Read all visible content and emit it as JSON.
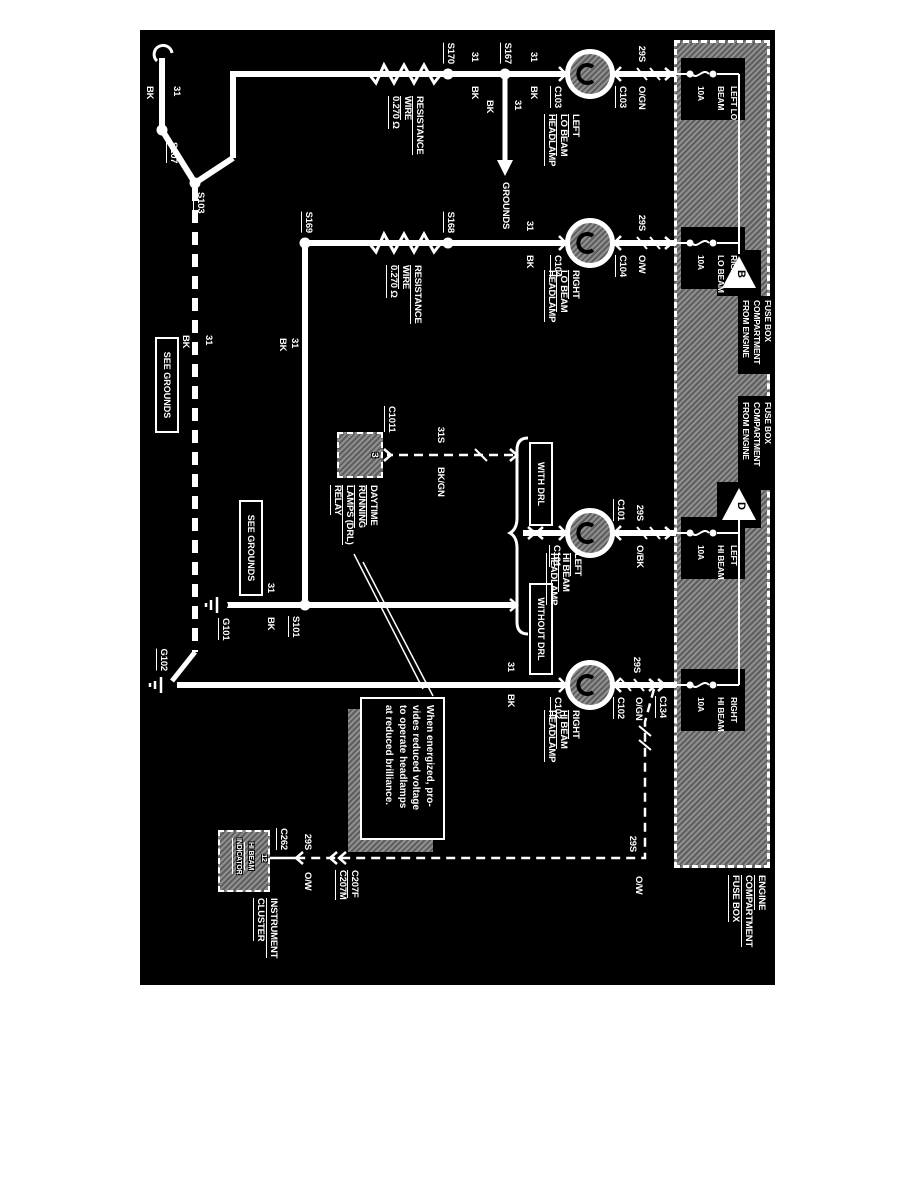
{
  "fuse_box": {
    "title_lines": [
      "ENGINE",
      "COMPARTMENT",
      "FUSE BOX"
    ],
    "from_label_lines": [
      "FROM ENGINE",
      "COMPARTMENT",
      "FUSE BOX"
    ],
    "triangles": [
      "B",
      "D"
    ],
    "fuses": [
      {
        "line1": "LEFT LO",
        "line2": "BEAM",
        "rating": "10A"
      },
      {
        "line1": "RIGHT",
        "line2": "LO BEAM",
        "rating": "10A"
      },
      {
        "line1": "LEFT",
        "line2": "HI BEAM",
        "rating": "10A"
      },
      {
        "line1": "RIGHT",
        "line2": "HI BEAM",
        "rating": "10A"
      }
    ]
  },
  "lamps": [
    {
      "name1": "LEFT",
      "name2": "LO BEAM",
      "name3": "HEADLAMP",
      "connector": "C103",
      "feed": "29S",
      "feed_color": "O/GN",
      "gnd": "31",
      "gnd_color": "BK"
    },
    {
      "name1": "RIGHT",
      "name2": "LO BEAM",
      "name3": "HEADLAMP",
      "connector": "C104",
      "feed": "29S",
      "feed_color": "O/W",
      "gnd": "31",
      "gnd_color": "BK"
    },
    {
      "name1": "LEFT",
      "name2": "HI BEAM",
      "name3": "HEADLAMP",
      "connector": "C101",
      "feed": "29S",
      "feed_color": "O/BK",
      "gnd": "31",
      "gnd_color": "BK"
    },
    {
      "name1": "RIGHT",
      "name2": "HI BEAM",
      "name3": "HEADLAMP",
      "connector": "C102",
      "feed": "29S",
      "feed_color": "O/GN",
      "gnd": "31",
      "gnd_color": "BK"
    }
  ],
  "resistor": {
    "line1": "RESISTANCE",
    "line2": "WIRE",
    "line3": "0.270 Ω"
  },
  "splices": {
    "s101": "S101",
    "s103": "S103",
    "s107": "S107",
    "s167": "S167",
    "s168": "S168",
    "s169": "S169",
    "s170": "S170"
  },
  "grounds": {
    "g101": "G101",
    "g102": "G102"
  },
  "labels": {
    "see_grounds": "SEE GROUNDS",
    "grounds": "GROUNDS",
    "with_drl": "WITH DRL",
    "without_drl": "WITHOUT DRL",
    "wire31": "31",
    "wire31_color": "BK",
    "wire31s": "31S",
    "wire31s_color": "BK/GN",
    "wire29s": "29S",
    "wire29s_ow": "O/W"
  },
  "relay": {
    "connector": "C1011",
    "pin": "3",
    "name1": "DAYTIME",
    "name2": "RUNNING",
    "name3": "LAMPS (DRL)",
    "name4": "RELAY"
  },
  "note": {
    "line1": "When energized, pro-",
    "line2": "vides reduced voltage",
    "line3": "to operate headlamps",
    "line4": "at reduced brilliance."
  },
  "cluster": {
    "name1": "INSTRUMENT",
    "name2": "CLUSTER",
    "ind1": "HI BEAM",
    "ind2": "INDICATOR",
    "pin": "12",
    "connector": "C262",
    "inline_m": "C207M",
    "inline_f": "C207F"
  },
  "c134": "C134",
  "colors": {
    "background": "#000000",
    "foreground": "#ffffff"
  }
}
